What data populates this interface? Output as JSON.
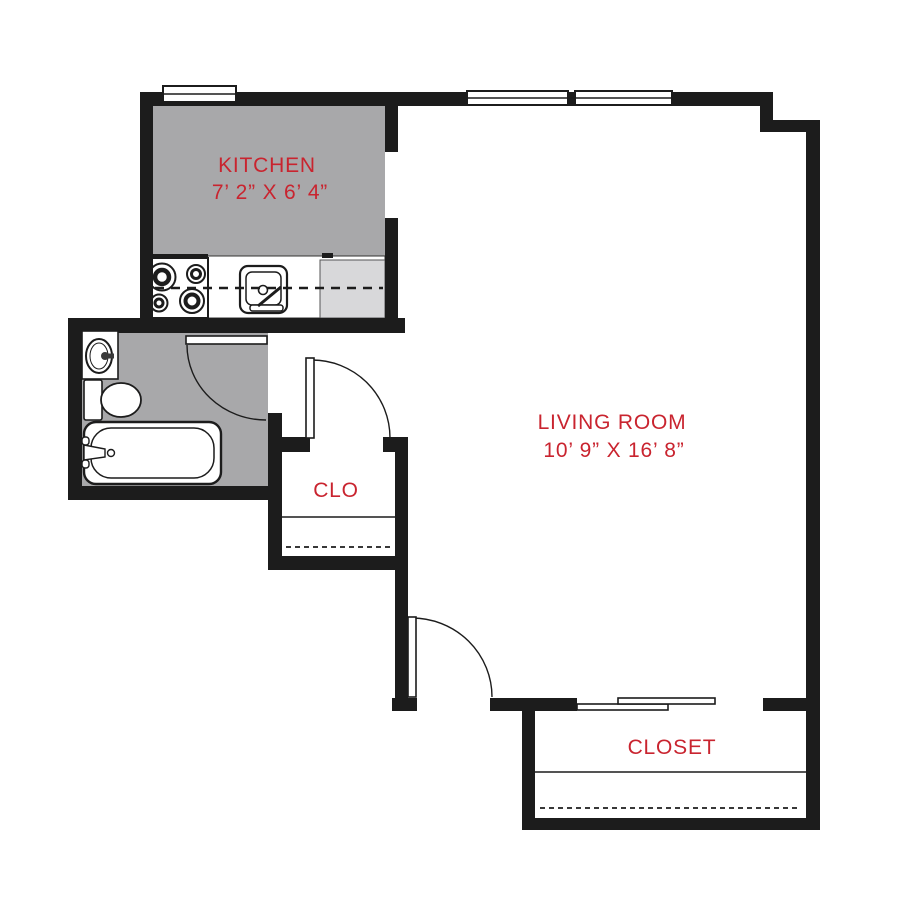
{
  "floor_plan": {
    "rooms": {
      "kitchen": {
        "label": "KITCHEN",
        "dimensions": "7’ 2” X 6’ 4”"
      },
      "living_room": {
        "label": "LIVING ROOM",
        "dimensions": "10’ 9” X 16’ 8”"
      },
      "hall_closet": {
        "label": "CLO"
      },
      "closet": {
        "label": "CLOSET"
      }
    },
    "colors": {
      "wall": "#1c1c1c",
      "room_fill": "#a8a8aa",
      "counter_fill": "#d8d8da",
      "label_text": "#c9242f",
      "background": "#ffffff"
    },
    "fixtures": [
      "range-burners",
      "kitchen-sink",
      "counter",
      "bathroom-sink",
      "toilet",
      "bathtub",
      "swing-door",
      "sliding-door",
      "window",
      "closet-shelf"
    ]
  }
}
